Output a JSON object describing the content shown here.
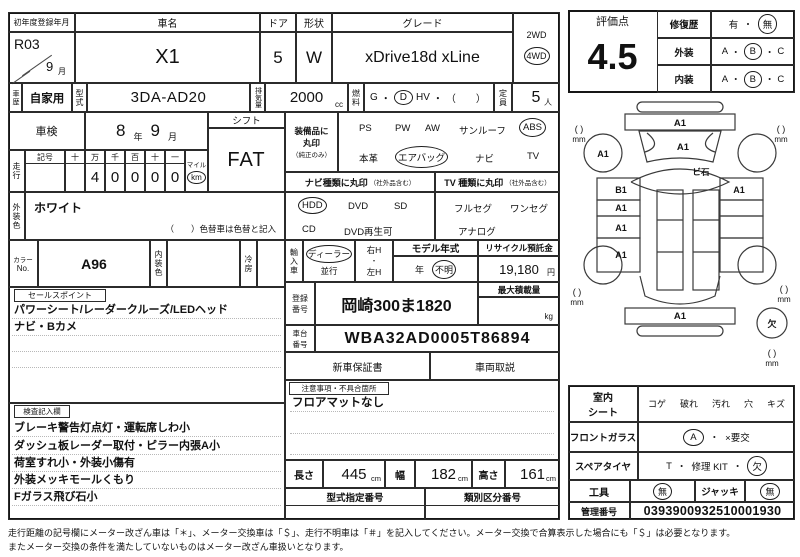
{
  "misc": {
    "dot": "・"
  },
  "reg": {
    "label": "初年度登録年月",
    "era_year": "R03",
    "month": "9",
    "month_unit": "月"
  },
  "car": {
    "name_label": "車名",
    "name": "X1",
    "doors_label": "ドア",
    "doors": "5",
    "shape_label": "形状",
    "shape": "W",
    "grade_label": "グレード",
    "grade": "xDrive18d xLine"
  },
  "drive": {
    "two": "2WD",
    "four": "4WD"
  },
  "history": {
    "label": "車歴",
    "value": "自家用"
  },
  "model": {
    "label": "型式",
    "value": "3DA-AD20"
  },
  "displacement": {
    "label": "排気量",
    "value": "2000",
    "unit": "cc"
  },
  "fuel": {
    "label": "燃料",
    "g": "G",
    "d": "D",
    "hv": "HV",
    "paren": "（　　）"
  },
  "capacity": {
    "label": "定員",
    "value": "5",
    "unit": "人"
  },
  "shaken": {
    "label": "車検",
    "year": "8",
    "year_unit": "年",
    "month": "9",
    "month_unit": "月"
  },
  "shift": {
    "label": "シフト",
    "value": "FAT"
  },
  "mileage": {
    "label": "走行",
    "sign": "記号",
    "cols": [
      "十",
      "万",
      "千",
      "百",
      "十",
      "一"
    ],
    "digits": [
      "",
      "4",
      "0",
      "0",
      "0",
      "0"
    ],
    "mile": "マイル",
    "km": "km"
  },
  "equipment": {
    "l1": "装備品に",
    "l2": "丸印",
    "l3": "（純正のみ）",
    "row1": [
      "PS",
      "PW",
      "AW",
      "サンルーフ",
      "ABS"
    ],
    "row2": [
      "本革",
      "エアバッグ",
      "ナビ",
      "TV"
    ]
  },
  "body_color": {
    "label": "外装色",
    "value": "ホワイト",
    "note": "（　　）色替車は色替と記入"
  },
  "color_no": {
    "l1": "カラー",
    "l2": "No.",
    "value": "A96"
  },
  "interior_color": {
    "label": "内装色"
  },
  "ac": {
    "label": "冷房"
  },
  "nav": {
    "header": "ナビ種類に丸印",
    "small": "（社外品含む）",
    "row1": [
      "HDD",
      "DVD",
      "SD"
    ],
    "row2": [
      "CD",
      "DVD再生可"
    ]
  },
  "tv": {
    "header": "TV 種類に丸印",
    "small": "（社外品含む）",
    "row1": [
      "フルセグ",
      "ワンセグ"
    ],
    "row2": [
      "アナログ"
    ]
  },
  "import_car": {
    "label": "輸入車",
    "dealer": "ディーラー",
    "parallel": "並行",
    "rh": "右H",
    "lh": "左H"
  },
  "model_year": {
    "header": "モデル年式",
    "unit": "年",
    "value": "不明"
  },
  "recycle": {
    "header": "リサイクル預託金",
    "value": "19,180",
    "unit": "円"
  },
  "reg_no": {
    "l1": "登録",
    "l2": "番号",
    "value": "岡崎300ま1820"
  },
  "max_load": {
    "header": "最大積載量",
    "unit": "kg"
  },
  "vin": {
    "l1": "車台",
    "l2": "番号",
    "value": "WBA32AD0005T86894"
  },
  "docs": {
    "warranty": "新車保証書",
    "manual": "車両取説"
  },
  "notes": {
    "header": "注意事項・不具合箇所",
    "line1": "フロアマットなし"
  },
  "sales": {
    "header": "セールスポイント",
    "line1": "パワーシート/レーダークルーズ/LEDヘッド",
    "line2": "ナビ・Bカメ"
  },
  "inspection": {
    "header": "検査記入欄",
    "lines": [
      "ブレーキ警告灯点灯・運転席しわ小",
      "ダッシュ板レーダー取付・ピラー内張A小",
      "荷室すれ小・外装小傷有",
      "外装メッキモールくもり",
      "Fガラス飛び石小"
    ]
  },
  "dims": {
    "length_label": "長さ",
    "length": "445",
    "width_label": "幅",
    "width": "182",
    "height_label": "高さ",
    "height": "161",
    "unit": "cm"
  },
  "type_no": {
    "label": "型式指定番号"
  },
  "class_no": {
    "label": "類別区分番号"
  },
  "evaluation": {
    "label": "評価点",
    "score": "4.5",
    "repair_label": "修復歴",
    "yes": "有",
    "no": "無",
    "ext_label": "外装",
    "int_label": "内装",
    "a": "A",
    "b": "B",
    "c": "C"
  },
  "diagram": {
    "front_bumper": "A1",
    "hood": "A1",
    "windshield": "ビ石",
    "fl_wheel": "A1",
    "left1": "B1",
    "left2": "A1",
    "left3": "A1",
    "left4": "A1",
    "right1": "A1",
    "rear_bumper": "A1",
    "spare": "欠",
    "bracket": "(  )",
    "mm": "mm"
  },
  "condition": {
    "seat_l1": "室内",
    "seat_l2": "シート",
    "seat_options": [
      "コゲ",
      "破れ",
      "汚れ",
      "穴",
      "キズ"
    ],
    "glass_label": "フロントガラス",
    "glass_a": "A",
    "glass_ng": "×要交",
    "spare_label": "スペアタイヤ",
    "spare_t": "T",
    "spare_kit": "修理 KIT",
    "spare_missing": "欠",
    "tools_label": "工具",
    "tools_value": "無",
    "jack_label": "ジャッキ",
    "jack_value": "無",
    "mgmt_label": "管理番号",
    "mgmt_value": "0393900932510001930"
  },
  "footer": {
    "line1": "走行距離の記号欄にメーター改ざん車は「＊」、メーター交換車は「＄」、走行不明車は「＃」を記入してください。メーター交換で合算表示した場合にも「＄」は必要となります。",
    "line2": "またメーター交換の条件を満たしていないものはメーター改ざん車扱いとなります。"
  }
}
